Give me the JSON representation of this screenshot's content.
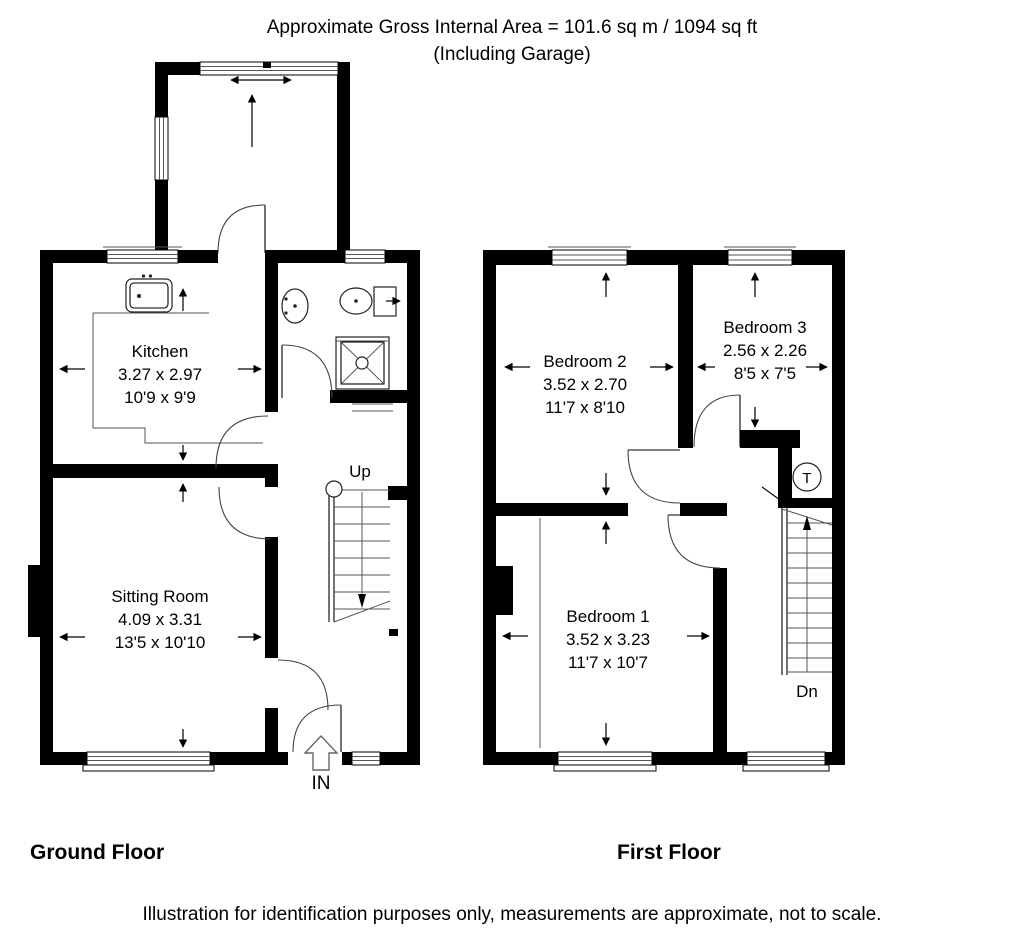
{
  "header": {
    "line1": "Approximate Gross Internal Area = 101.6 sq m / 1094 sq ft",
    "line2": "(Including Garage)"
  },
  "floors": {
    "ground": {
      "label": "Ground Floor"
    },
    "first": {
      "label": "First Floor"
    }
  },
  "rooms": {
    "kitchen": {
      "name": "Kitchen",
      "metric": "3.27 x 2.97",
      "imperial": "10'9 x 9'9"
    },
    "sitting_room": {
      "name": "Sitting Room",
      "metric": "4.09 x 3.31",
      "imperial": "13'5 x 10'10"
    },
    "bedroom1": {
      "name": "Bedroom 1",
      "metric": "3.52 x 3.23",
      "imperial": "11'7 x 10'7"
    },
    "bedroom2": {
      "name": "Bedroom 2",
      "metric": "3.52 x 2.70",
      "imperial": "11'7 x 8'10"
    },
    "bedroom3": {
      "name": "Bedroom 3",
      "metric": "2.56 x 2.26",
      "imperial": "8'5 x 7'5"
    }
  },
  "annotations": {
    "stairs_up": "Up",
    "stairs_down": "Dn",
    "entrance": "IN",
    "tank": "T"
  },
  "footer": {
    "text": "Illustration for identification purposes only, measurements are approximate, not to scale."
  },
  "colors": {
    "wall": "#000000",
    "background": "#ffffff",
    "line": "#444444"
  }
}
